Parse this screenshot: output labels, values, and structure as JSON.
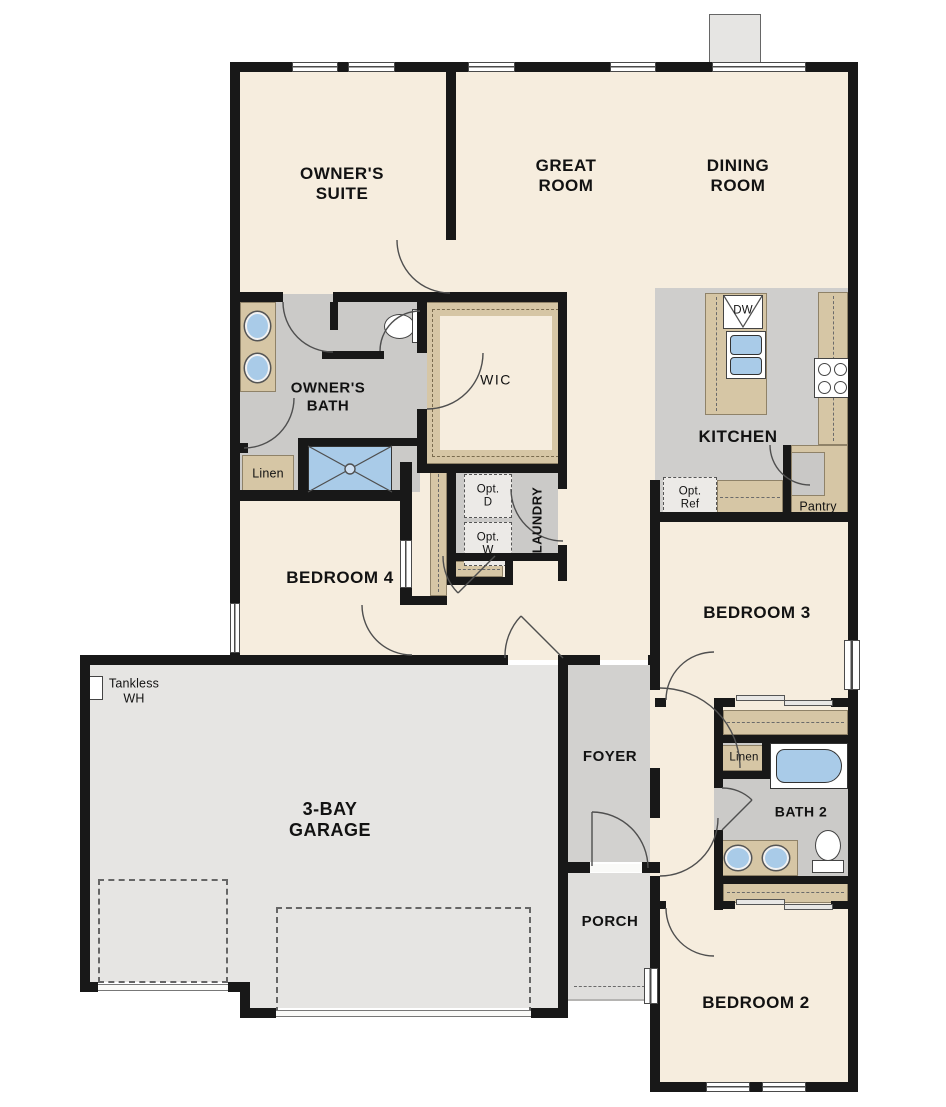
{
  "floorplan": {
    "title": "Single-story 4-bedroom floor plan",
    "labels": {
      "owners_suite": "OWNER'S SUITE",
      "great_room": "GREAT ROOM",
      "dining_room": "DINING ROOM",
      "owners_bath": "OWNER'S BATH",
      "wic": "WIC",
      "linen_owners": "Linen",
      "bedroom4": "BEDROOM 4",
      "laundry": "LAUNDRY",
      "opt_d": "Opt. D",
      "opt_w": "Opt. W",
      "kitchen": "KITCHEN",
      "opt_ref": "Opt. Ref",
      "pantry": "Pantry",
      "dw": "DW",
      "bedroom3": "BEDROOM 3",
      "tankless_wh": "Tankless WH",
      "garage": "3-BAY GARAGE",
      "foyer": "FOYER",
      "porch": "PORCH",
      "linen_bath2": "Linen",
      "bath2": "BATH 2",
      "bedroom2": "BEDROOM 2"
    },
    "colors": {
      "wall": "#181818",
      "room_floor": "#f6edde",
      "wet_floor": "#cbcac8",
      "kitchen_floor": "#cfcecc",
      "foyer_floor": "#d2d1cf",
      "porch_floor": "#dfdedc",
      "garage_floor": "#e6e5e3",
      "cabinet_tan": "#d6c6a5",
      "fixture_blue": "#a9cbe8"
    }
  }
}
